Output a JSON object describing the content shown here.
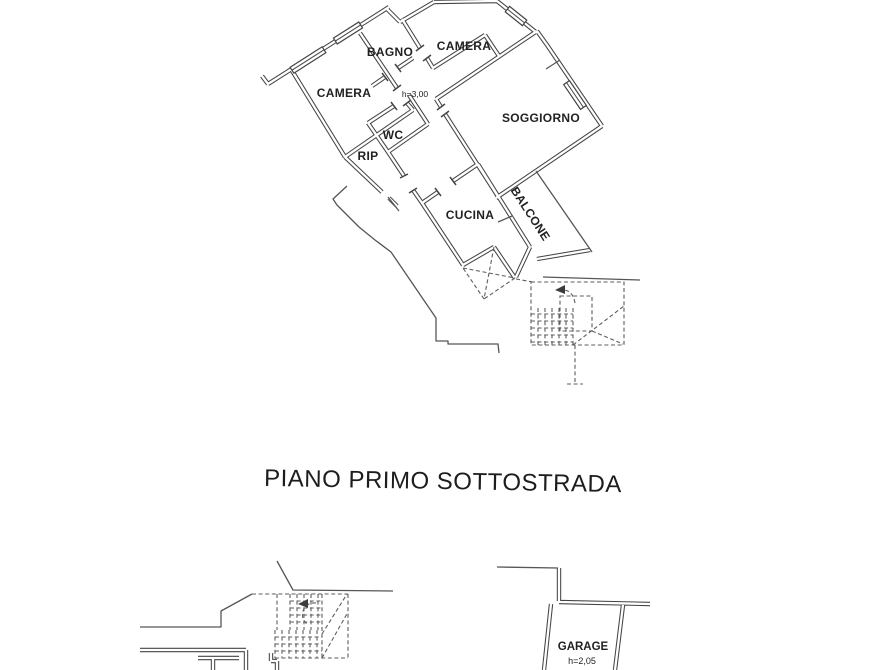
{
  "page": {
    "background_color": "#ffffff",
    "ink_color": "#454545",
    "type_note": "scanned cadastral floor plan (planimetria catastale)"
  },
  "upper_plan": {
    "rooms": [
      {
        "id": "camera-left",
        "label": "CAMERA"
      },
      {
        "id": "bagno",
        "label": "BAGNO"
      },
      {
        "id": "camera-top",
        "label": "CAMERA"
      },
      {
        "id": "wc",
        "label": "WC"
      },
      {
        "id": "rip",
        "label": "RIP"
      },
      {
        "id": "soggiorno",
        "label": "SOGGIORNO"
      },
      {
        "id": "cucina",
        "label": "CUCINA"
      },
      {
        "id": "balcone",
        "label": "BALCONE"
      }
    ],
    "ceiling_height_note": "h=3,00"
  },
  "caption": {
    "text": "PIANO PRIMO SOTTOSTRADA"
  },
  "lower_plan": {
    "garage_label": "GARAGE",
    "garage_height_note": "h=2,05"
  }
}
